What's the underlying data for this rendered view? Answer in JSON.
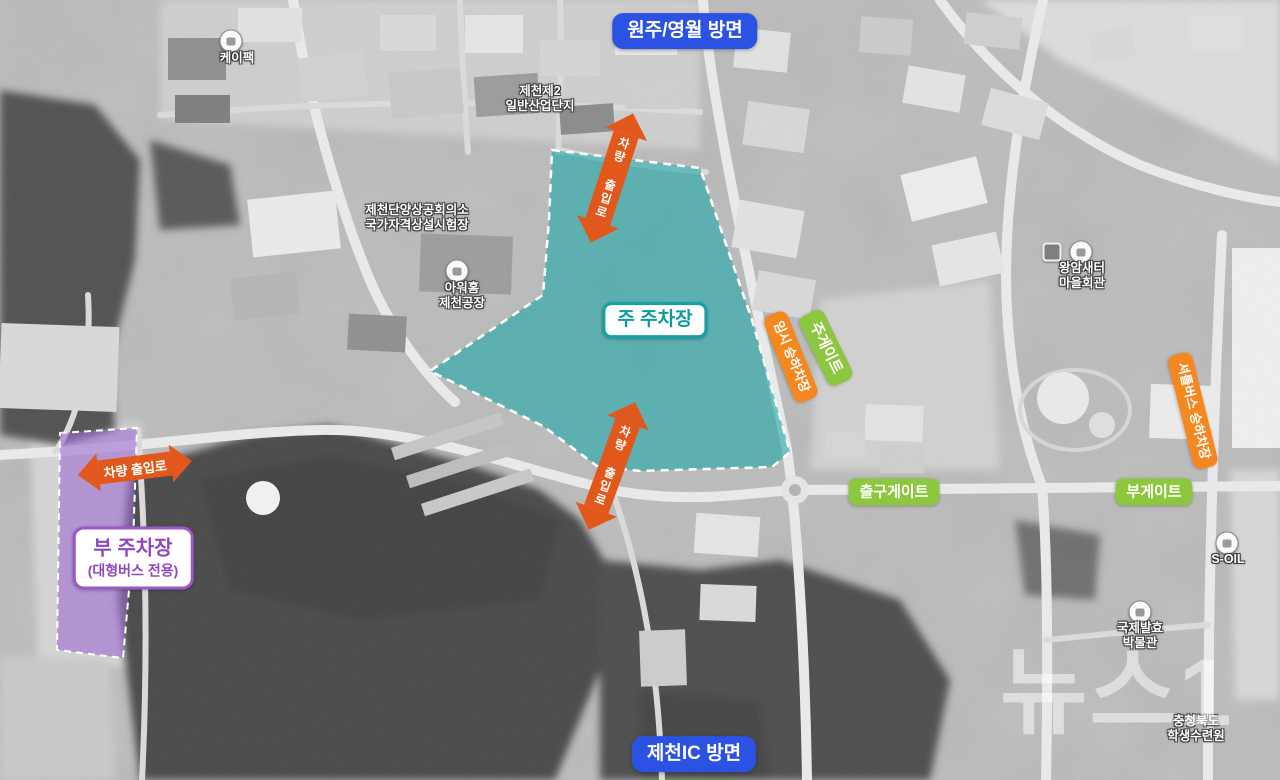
{
  "badges": {
    "direction_top": "원주/영월 방면",
    "direction_bottom": "제천IC 방면",
    "main_parking": "주 주차장",
    "sub_parking_title": "부 주차장",
    "sub_parking_subtitle": "(대형버스 전용)",
    "main_gate": "주게이트",
    "exit_gate": "출구게이트",
    "sub_gate": "부게이트",
    "temporary_stop": "임시 승하차장",
    "shuttle_stop": "셔틀버스 승하차장",
    "vehicle_access": "차량 출입로"
  },
  "poi_labels": {
    "kpack": "케이팩",
    "industrial_line1": "제천제2",
    "industrial_line2": "일반산업단지",
    "chamber_line1": "제천단양상공회의소",
    "chamber_line2": "국가자격상설시험장",
    "ourhome_line1": "아워홈",
    "ourhome_line2": "제천공장",
    "village_line1": "왕암새터",
    "village_line2": "마을회관",
    "soil": "S-OIL",
    "museum_line1": "국제발효",
    "museum_line2": "박물관",
    "training_line1": "충청북도",
    "training_line2": "학생수련원"
  },
  "watermark": "뉴스1",
  "colors": {
    "direction_blue": "#2b52e2",
    "gate_green": "#8dc63f",
    "stop_orange": "#f6871f",
    "arrow_orange": "#e2581c",
    "main_parking_teal": "#1fa9a8",
    "sub_parking_purple": "#9a68cf"
  }
}
